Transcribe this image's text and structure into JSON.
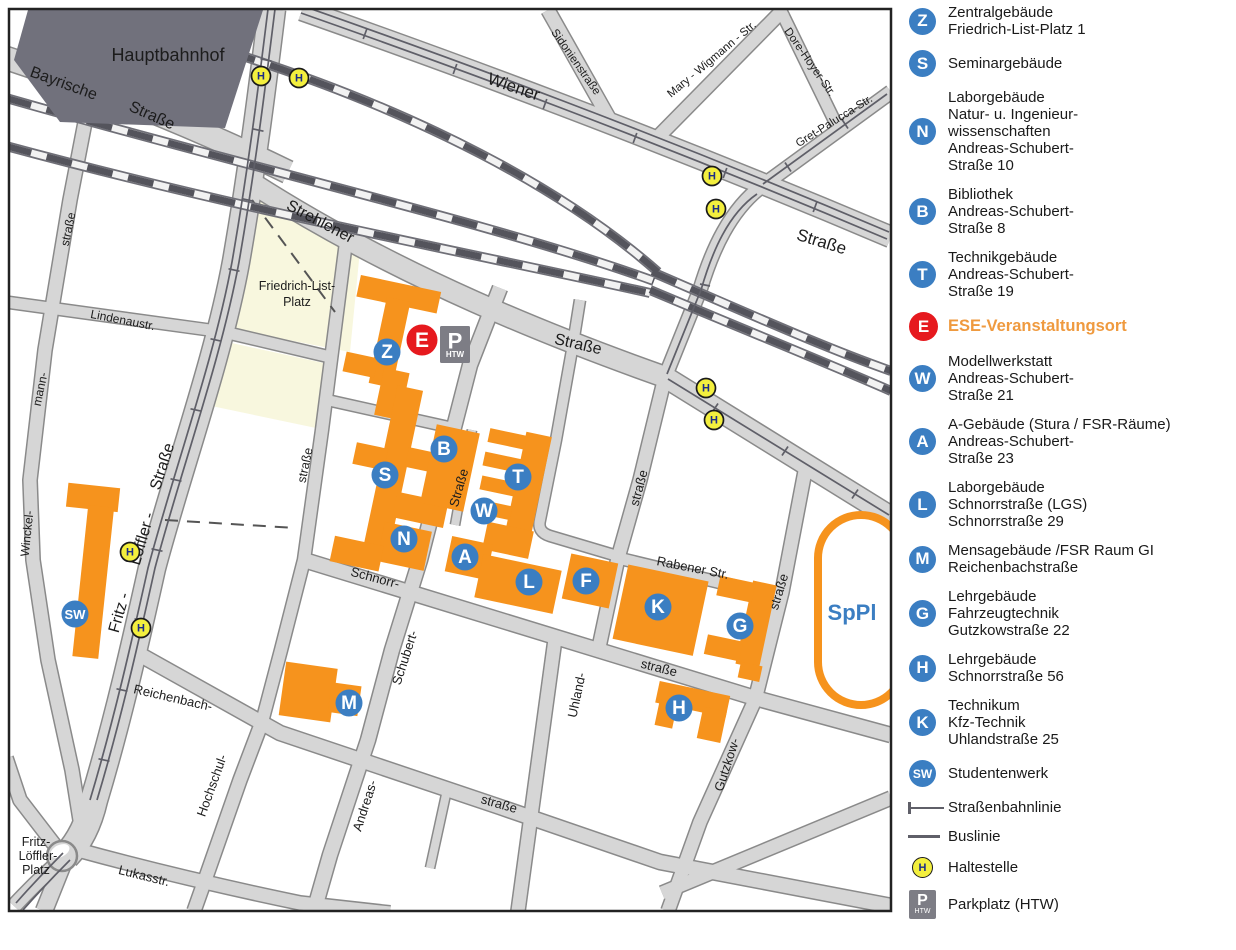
{
  "map": {
    "labels": [
      {
        "t": "Hauptbahnhof",
        "x": 168,
        "y": 61,
        "s": 18
      },
      {
        "t": "Bayrische",
        "x": 62,
        "y": 88,
        "r": 20,
        "s": 16
      },
      {
        "t": "Straße",
        "x": 150,
        "y": 120,
        "r": 24,
        "s": 16
      },
      {
        "t": "Wiener",
        "x": 512,
        "y": 92,
        "r": 19,
        "s": 17
      },
      {
        "t": "Straße",
        "x": 820,
        "y": 247,
        "r": 17,
        "s": 17
      },
      {
        "t": "Sidonienstraße",
        "x": 573,
        "y": 64,
        "r": 55,
        "s": 11.5
      },
      {
        "t": "Mary - Wigmann - Str.",
        "x": 714,
        "y": 62,
        "r": -40,
        "s": 11.5
      },
      {
        "t": "Dore-Hoyer-Str.",
        "x": 807,
        "y": 64,
        "r": 55,
        "s": 11.5
      },
      {
        "t": "Gret-Palucca-Str.",
        "x": 836,
        "y": 124,
        "r": -32,
        "s": 11.5
      },
      {
        "t": "Strehlener",
        "x": 318,
        "y": 226,
        "r": 28,
        "s": 16
      },
      {
        "t": "Straße",
        "x": 577,
        "y": 349,
        "r": 13,
        "s": 16
      },
      {
        "t": "straße",
        "x": 72,
        "y": 230,
        "r": -78,
        "s": 12
      },
      {
        "t": "mann-",
        "x": 44,
        "y": 390,
        "r": -78,
        "s": 12
      },
      {
        "t": "Winckel-",
        "x": 31,
        "y": 534,
        "r": -84,
        "s": 12
      },
      {
        "t": "Lindenaustr.",
        "x": 122,
        "y": 324,
        "r": 11,
        "s": 12
      },
      {
        "t": "Fritz -",
        "x": 124,
        "y": 614,
        "r": -74,
        "s": 16
      },
      {
        "t": "Löffler -",
        "x": 147,
        "y": 540,
        "r": -74,
        "s": 16
      },
      {
        "t": "Straße",
        "x": 167,
        "y": 468,
        "r": -72,
        "s": 16
      },
      {
        "t": "straße",
        "x": 309,
        "y": 466,
        "r": -78,
        "s": 12.5
      },
      {
        "t": "Friedrich-List-",
        "x": 297,
        "y": 290,
        "s": 12.5
      },
      {
        "t": "Platz",
        "x": 297,
        "y": 306,
        "s": 12.5
      },
      {
        "t": "Straße",
        "x": 463,
        "y": 489,
        "r": -74,
        "s": 13
      },
      {
        "t": "Schubert-",
        "x": 409,
        "y": 659,
        "r": -72,
        "s": 13
      },
      {
        "t": "Andreas-",
        "x": 369,
        "y": 807,
        "r": -72,
        "s": 13
      },
      {
        "t": "Schnorr-",
        "x": 374,
        "y": 582,
        "r": 15,
        "s": 13
      },
      {
        "t": "straße",
        "x": 658,
        "y": 672,
        "r": 14,
        "s": 13
      },
      {
        "t": "Reichenbach-",
        "x": 172,
        "y": 702,
        "r": 13,
        "s": 13
      },
      {
        "t": "straße",
        "x": 498,
        "y": 808,
        "r": 16,
        "s": 13
      },
      {
        "t": "Hochschul-",
        "x": 216,
        "y": 787,
        "r": -70,
        "s": 13
      },
      {
        "t": "Lukasstr.",
        "x": 143,
        "y": 880,
        "r": 14,
        "s": 13
      },
      {
        "t": "Uhland-",
        "x": 581,
        "y": 696,
        "r": -78,
        "s": 13
      },
      {
        "t": "straße",
        "x": 643,
        "y": 489,
        "r": -75,
        "s": 13
      },
      {
        "t": "Rabener Str.",
        "x": 692,
        "y": 572,
        "r": 11,
        "s": 13
      },
      {
        "t": "straße",
        "x": 783,
        "y": 593,
        "r": -73,
        "s": 13
      },
      {
        "t": "Gutzkow-",
        "x": 731,
        "y": 766,
        "r": -72,
        "s": 13
      },
      {
        "t": "Fritz-",
        "x": 36,
        "y": 846,
        "s": 12.5
      },
      {
        "t": "Löffler-",
        "x": 38,
        "y": 860,
        "s": 12.5
      },
      {
        "t": "Platz",
        "x": 36,
        "y": 874,
        "s": 12.5
      },
      {
        "t": "SpPl",
        "x": 852,
        "y": 620,
        "s": 22,
        "c": "#3b7ec2",
        "b": true
      }
    ],
    "markers": [
      {
        "l": "Z",
        "x": 387,
        "y": 352
      },
      {
        "l": "B",
        "x": 444,
        "y": 449
      },
      {
        "l": "S",
        "x": 385,
        "y": 475
      },
      {
        "l": "N",
        "x": 404,
        "y": 539
      },
      {
        "l": "T",
        "x": 518,
        "y": 477
      },
      {
        "l": "W",
        "x": 484,
        "y": 511
      },
      {
        "l": "A",
        "x": 465,
        "y": 557
      },
      {
        "l": "L",
        "x": 529,
        "y": 582
      },
      {
        "l": "F",
        "x": 586,
        "y": 581
      },
      {
        "l": "K",
        "x": 658,
        "y": 607
      },
      {
        "l": "G",
        "x": 740,
        "y": 626
      },
      {
        "l": "M",
        "x": 349,
        "y": 703
      },
      {
        "l": "H",
        "x": 679,
        "y": 708
      },
      {
        "l": "SW",
        "x": 75,
        "y": 614,
        "small": true
      }
    ],
    "event_marker": {
      "l": "E",
      "x": 422,
      "y": 340
    },
    "parking": {
      "x": 455,
      "y": 326,
      "label": "P",
      "sub": "HTW"
    },
    "stops": [
      {
        "x": 261,
        "y": 76
      },
      {
        "x": 299,
        "y": 78
      },
      {
        "x": 712,
        "y": 176
      },
      {
        "x": 716,
        "y": 209
      },
      {
        "x": 706,
        "y": 388
      },
      {
        "x": 714,
        "y": 420
      },
      {
        "x": 130,
        "y": 552
      },
      {
        "x": 141,
        "y": 628
      }
    ],
    "colors": {
      "building": "#f6931d",
      "marker_blue": "#3b7ec2",
      "event_red": "#e6191e",
      "stop_yellow": "#f3ef3e",
      "stop_letter": "#1b2c87",
      "station_gray": "#71717c",
      "platz_yellow": "#f8f7de",
      "road": "#d6d6d6",
      "road_edge": "#8a8a8a",
      "rail": "#54545c"
    }
  },
  "legend": {
    "items": [
      {
        "type": "marker",
        "letter": "Z",
        "lines": [
          "Zentralgebäude",
          "Friedrich-List-Platz 1"
        ]
      },
      {
        "type": "marker",
        "letter": "S",
        "lines": [
          "Seminargebäude"
        ]
      },
      {
        "type": "marker",
        "letter": "N",
        "lines": [
          "Laborgebäude",
          "Natur- u. Ingenieur-",
          "wissenschaften",
          "Andreas-Schubert-",
          "Straße 10"
        ]
      },
      {
        "type": "marker",
        "letter": "B",
        "lines": [
          "Bibliothek",
          "Andreas-Schubert-",
          "Straße 8"
        ]
      },
      {
        "type": "marker",
        "letter": "T",
        "lines": [
          "Technikgebäude",
          "Andreas-Schubert-",
          "Straße 19"
        ]
      },
      {
        "type": "marker",
        "letter": "E",
        "red": true,
        "highlight": true,
        "lines": [
          "ESE-Veranstaltungsort"
        ]
      },
      {
        "type": "marker",
        "letter": "W",
        "lines": [
          "Modellwerkstatt",
          "Andreas-Schubert-",
          "Straße 21"
        ]
      },
      {
        "type": "marker",
        "letter": "A",
        "lines": [
          "A-Gebäude (Stura / FSR-Räume)",
          "Andreas-Schubert-",
          "Straße 23"
        ]
      },
      {
        "type": "marker",
        "letter": "L",
        "lines": [
          "Laborgebäude",
          "Schnorrstraße (LGS)",
          "Schnorrstraße 29"
        ]
      },
      {
        "type": "marker",
        "letter": "M",
        "lines": [
          "Mensagebäude /FSR Raum GI",
          "Reichenbachstraße"
        ]
      },
      {
        "type": "marker",
        "letter": "G",
        "lines": [
          "Lehrgebäude",
          "Fahrzeugtechnik",
          "Gutzkowstraße 22"
        ]
      },
      {
        "type": "marker",
        "letter": "H",
        "lines": [
          "Lehrgebäude",
          "Schnorrstraße 56"
        ]
      },
      {
        "type": "marker",
        "letter": "K",
        "lines": [
          "Technikum",
          "Kfz-Technik",
          "Uhlandstraße 25"
        ]
      },
      {
        "type": "marker",
        "letter": "SW",
        "small": true,
        "lines": [
          "Studentenwerk"
        ]
      },
      {
        "type": "tram",
        "lines": [
          "Straßenbahnlinie"
        ]
      },
      {
        "type": "bus",
        "lines": [
          "Buslinie"
        ]
      },
      {
        "type": "stop",
        "letter": "H",
        "lines": [
          "Haltestelle"
        ]
      },
      {
        "type": "parking",
        "letter": "P",
        "sub": "HTW",
        "lines": [
          "Parkplatz (HTW)"
        ]
      }
    ]
  }
}
